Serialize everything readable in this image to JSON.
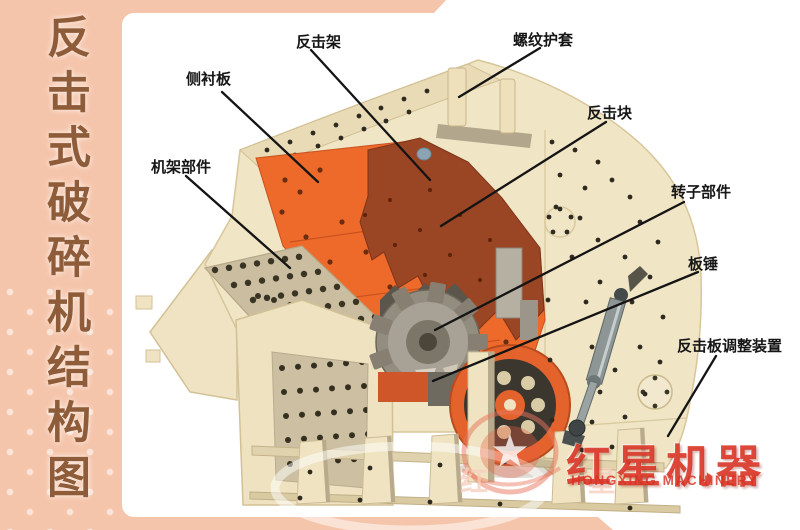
{
  "page": {
    "background": "#f5c5ab",
    "panel": "#ffffff"
  },
  "sidebar": {
    "title": "反击式破碎机结构图",
    "title_color": "#8e5c39"
  },
  "diagram": {
    "labels": [
      {
        "id": "impact-frame",
        "text": "反击架"
      },
      {
        "id": "thread-sleeve",
        "text": "螺纹护套"
      },
      {
        "id": "side-liner",
        "text": "侧衬板"
      },
      {
        "id": "impact-block",
        "text": "反击块"
      },
      {
        "id": "frame-part",
        "text": "机架部件"
      },
      {
        "id": "rotor-part",
        "text": "转子部件"
      },
      {
        "id": "blow-bar",
        "text": "板锤"
      },
      {
        "id": "adjust-device",
        "text": "反击板调整装置"
      }
    ],
    "colors": {
      "machine_body": "#f0e5c5",
      "chamber_orange": "#ee6a2b",
      "impact_block_dark": "#9a4523",
      "steel_gray": "#8d9595",
      "flywheel_dark": "#3b372f"
    }
  },
  "brand": {
    "name_cn": "红星机器",
    "name_en": "HONGXING MACHINERY",
    "watermark": "红 星",
    "color": "#d93a28"
  }
}
